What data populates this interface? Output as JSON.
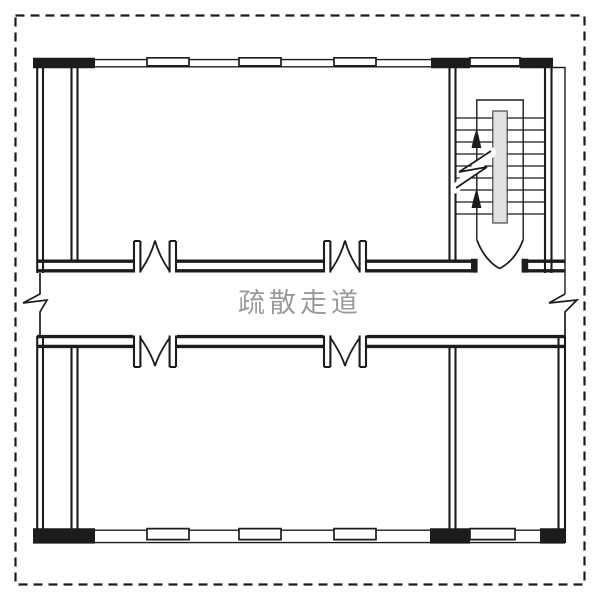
{
  "drawing": {
    "type": "architectural-floor-plan",
    "corridor_label": "疏散走道"
  },
  "colors": {
    "line": "#1c1c1c",
    "corridor_label": "#9a9a9a",
    "background": "#ffffff",
    "stair_divider_fill": "#e2e2e2"
  },
  "symbols": {
    "door_symbol": "double-leaf-door-swing",
    "break_symbol": "zigzag-continuation-break",
    "stair_arrow": "up-direction-arrow",
    "window_symbol": "exterior-wall-window"
  }
}
